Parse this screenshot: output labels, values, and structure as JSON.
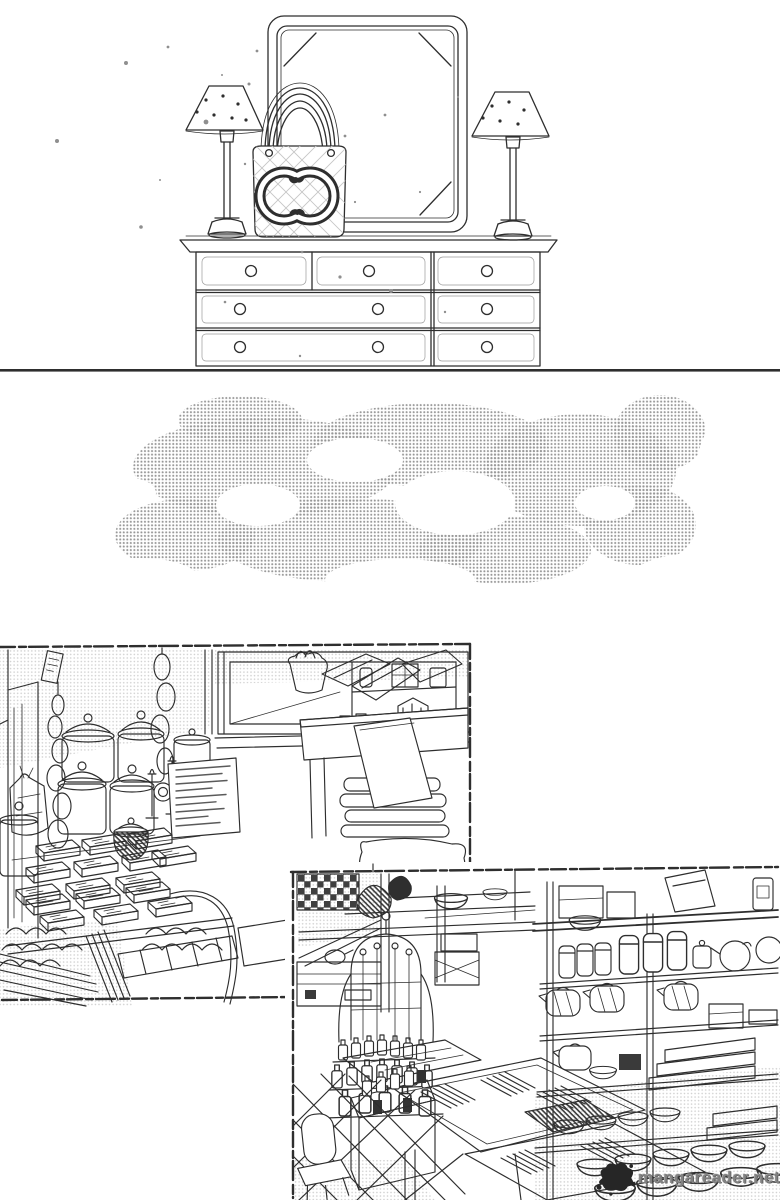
{
  "page": {
    "kind": "black-and-white manga page scan",
    "colors": {
      "paper": "#ffffff",
      "ink": "#2e2e2e",
      "tone": "#969696",
      "tone-light": "#aaaaaa",
      "dark": "#262626",
      "watermark": "#828282"
    }
  },
  "watermark": {
    "text": "mangareader.net",
    "logo": "ink-splat-logo"
  },
  "panels": [
    {
      "id": "top-dresser",
      "label": "Dresser top with framed mirror, two small shaded lamps and a quilted interlocking-CC tote bag; three rows of drawers with round knobs"
    },
    {
      "id": "cloud-tone-strip",
      "label": "Halftone screentone cloud strip"
    },
    {
      "id": "shop-interior-left",
      "label": "Shop interior: hanging bead chains, glass lidded canisters, menu sign board, stacked merchandise boxes, fabric rolls, display window and folded cloth stacks"
    },
    {
      "id": "shop-interior-right",
      "label": "Kitchenware shop: arched bottle rack, bins of chopsticks, tiled floor with chair, shelves of canisters, teapots and bowls"
    }
  ]
}
